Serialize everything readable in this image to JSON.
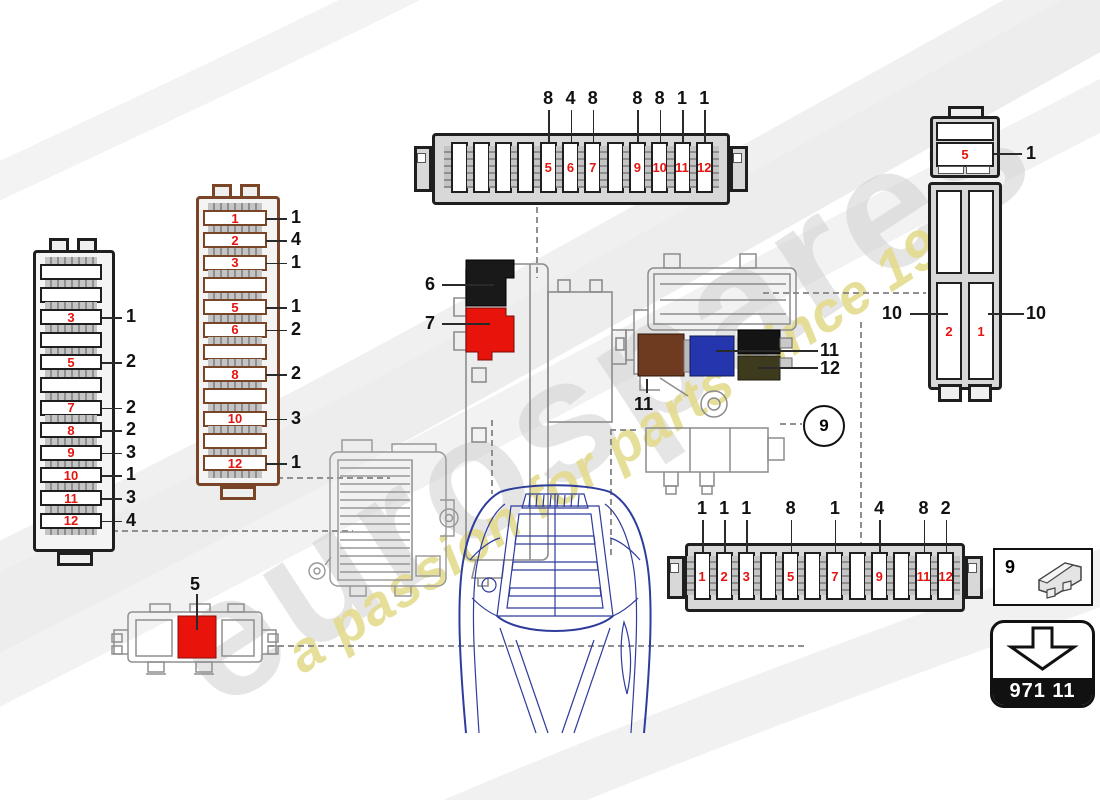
{
  "watermark": {
    "brand": "eurospares",
    "tagline": "a passion for parts since 1985"
  },
  "colors": {
    "fuse_number_red": "#e41410",
    "callout_black": "#111111",
    "black_frame": "#1f1f1f",
    "brown_frame": "#7a4527",
    "fuse_red": "#e8130b",
    "fuse_black": "#191919",
    "fuse_brown": "#6e3b20",
    "fuse_blue": "#2435ad",
    "fuse_olive": "#3e3a1e",
    "car_blue": "#2e3c9b",
    "line_gray": "#8c8c8c",
    "watermark_gray": "#cdcdcd",
    "watermark_yellow": "#e4dc8e"
  },
  "panels": {
    "left_vertical": {
      "slots": [
        {
          "num": "",
          "callout": ""
        },
        {
          "num": "",
          "callout": ""
        },
        {
          "num": "3",
          "callout": "1"
        },
        {
          "num": "",
          "callout": ""
        },
        {
          "num": "5",
          "callout": "2"
        },
        {
          "num": "",
          "callout": ""
        },
        {
          "num": "7",
          "callout": "2"
        },
        {
          "num": "8",
          "callout": "2"
        },
        {
          "num": "9",
          "callout": "3"
        },
        {
          "num": "10",
          "callout": "1"
        },
        {
          "num": "11",
          "callout": "3"
        },
        {
          "num": "12",
          "callout": "4"
        }
      ]
    },
    "brown_vertical": {
      "slots": [
        {
          "num": "1",
          "callout": "1"
        },
        {
          "num": "2",
          "callout": "4"
        },
        {
          "num": "3",
          "callout": "1"
        },
        {
          "num": "",
          "callout": ""
        },
        {
          "num": "5",
          "callout": "1"
        },
        {
          "num": "6",
          "callout": "2"
        },
        {
          "num": "",
          "callout": ""
        },
        {
          "num": "8",
          "callout": "2"
        },
        {
          "num": "",
          "callout": ""
        },
        {
          "num": "10",
          "callout": "3"
        },
        {
          "num": "",
          "callout": ""
        },
        {
          "num": "12",
          "callout": "1"
        }
      ]
    },
    "top_horizontal": {
      "slots": [
        {
          "num": "",
          "callout": ""
        },
        {
          "num": "",
          "callout": ""
        },
        {
          "num": "",
          "callout": ""
        },
        {
          "num": "",
          "callout": ""
        },
        {
          "num": "5",
          "callout": "8"
        },
        {
          "num": "6",
          "callout": "4"
        },
        {
          "num": "7",
          "callout": "8"
        },
        {
          "num": "",
          "callout": ""
        },
        {
          "num": "9",
          "callout": "8"
        },
        {
          "num": "10",
          "callout": "8"
        },
        {
          "num": "11",
          "callout": "1"
        },
        {
          "num": "12",
          "callout": "1"
        }
      ]
    },
    "bottom_horizontal": {
      "slots": [
        {
          "num": "1",
          "callout": "1"
        },
        {
          "num": "2",
          "callout": "1"
        },
        {
          "num": "3",
          "callout": "1"
        },
        {
          "num": "",
          "callout": ""
        },
        {
          "num": "5",
          "callout": "8"
        },
        {
          "num": "",
          "callout": ""
        },
        {
          "num": "7",
          "callout": "1"
        },
        {
          "num": "",
          "callout": ""
        },
        {
          "num": "9",
          "callout": "4"
        },
        {
          "num": "",
          "callout": ""
        },
        {
          "num": "11",
          "callout": "8"
        },
        {
          "num": "12",
          "callout": "2"
        }
      ]
    },
    "right_vertical": {
      "top_slot": {
        "num": "5",
        "callout": "1"
      },
      "main": {
        "left_num": "2",
        "right_num": "1",
        "left_callout": "10",
        "right_callout": "10"
      }
    }
  },
  "labels": {
    "black_fuse": "6",
    "red_fuse": "7",
    "assembly_brown_fuse": "11",
    "assembly_blue_fuse": "11",
    "assembly_dark_fuse": "12",
    "small_holder_fuse": "5"
  },
  "circle_ref": "9",
  "legend": {
    "ref": "9"
  },
  "part_code": "971 11"
}
